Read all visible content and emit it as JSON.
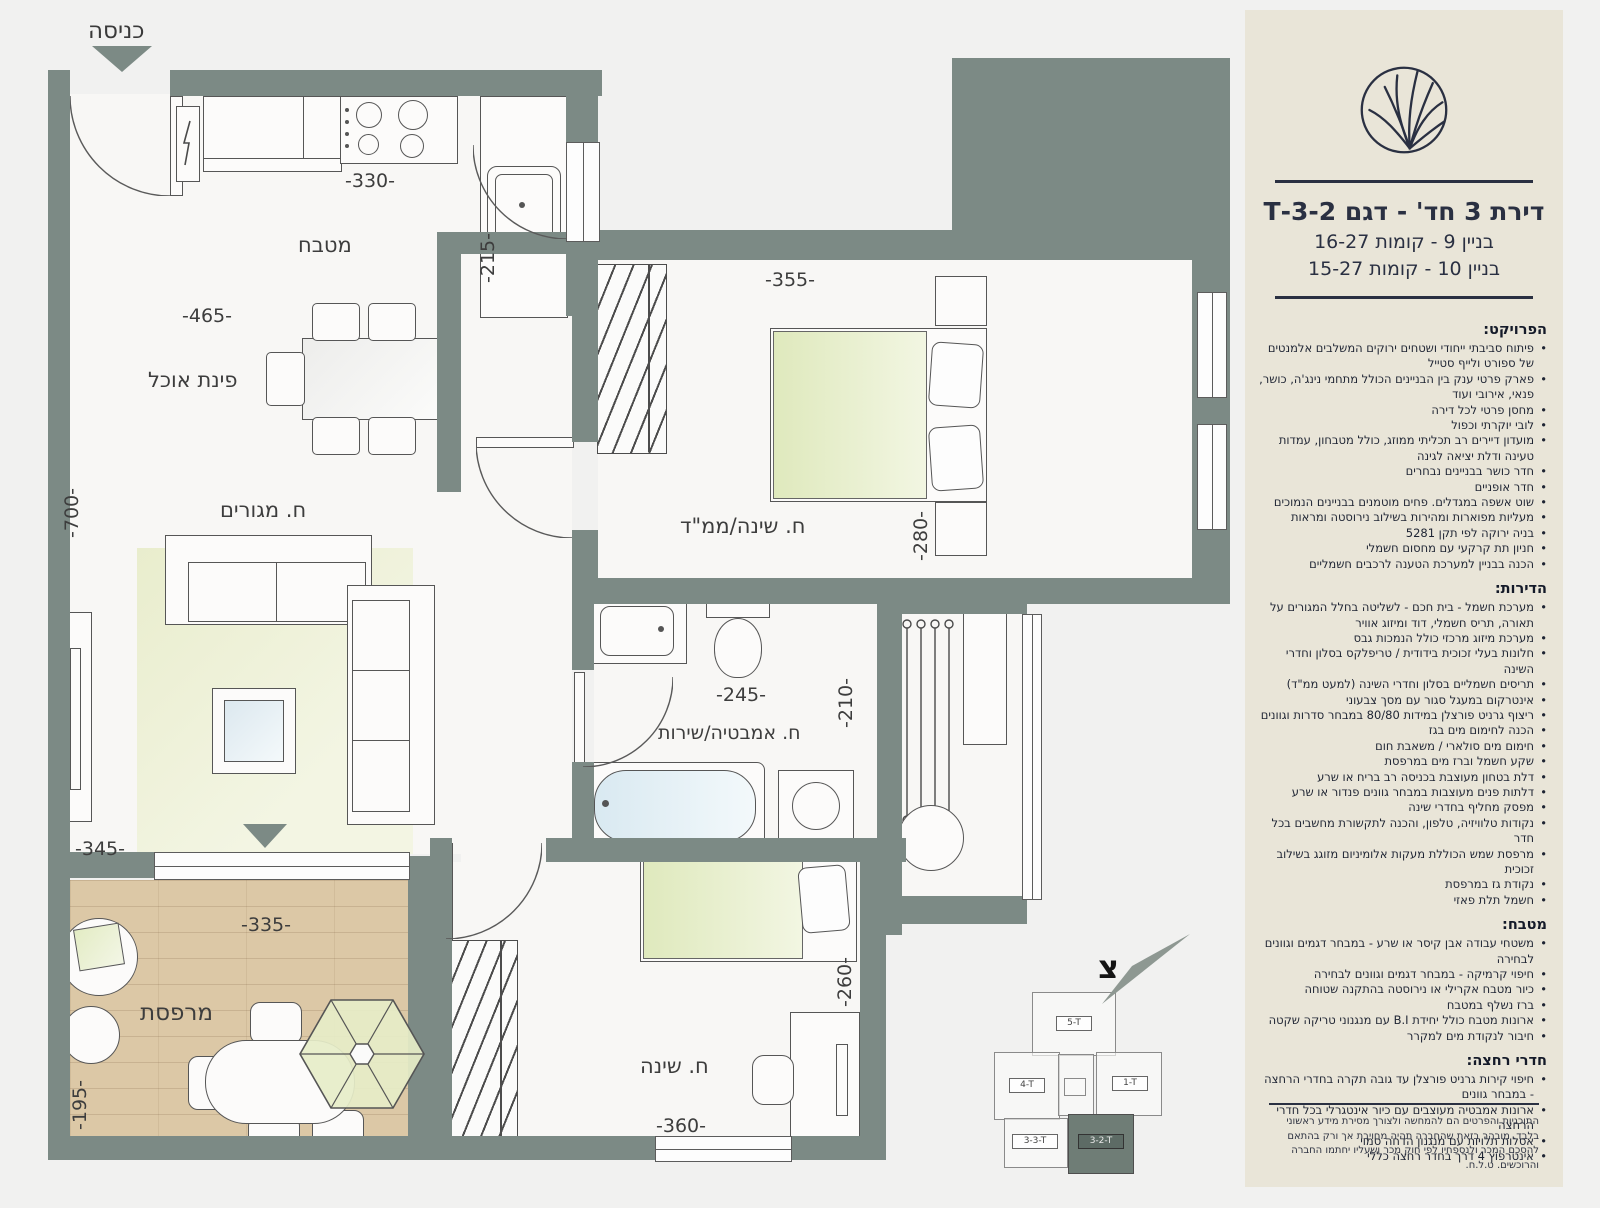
{
  "panel": {
    "title": "דירת 3 חד' - דגם 3-2-T",
    "building_lines": [
      "בניין 9  - קומות 16-27",
      "בניין 10 - קומות 15-27"
    ],
    "sections": [
      {
        "heading": "הפרויקט:",
        "items": [
          "פיתוח סביבתי ייחודי ושטחים ירוקים המשלבים אלמנטים של ספורט ולייף סטייל",
          "פארק פרטי ענק בין הבניינים הכולל מתחמי נינג'ה, כושר, פנאי, אירובי ועוד",
          "מחסן פרטי לכל דירה",
          "לובי יוקרתי וכפול",
          "מועדון דיירים רב תכליתי ממוזג, כולל מטבחון, עמדות טעינה ודלת יציאה לגינה",
          "חדר כושר בבניינים נבחרים",
          "חדר אופניים",
          "שוט אשפה במגדלים. פחים מוטמנים בבניינים הנמוכים",
          "מעליות מפוארות ומהירות בשילוב נירוסטה ומראות",
          "בניה ירוקה לפי תקן 5281",
          "חניון תת קרקעי עם מחסום חשמלי",
          "הכנה בבניין למערכת הטענה לרכבים חשמליים"
        ]
      },
      {
        "heading": "הדירות:",
        "items": [
          "מערכת חשמל - בית חכם - לשליטה בחלל המגורים על תאורה, תריס חשמלי, דוד ומיזוג אוויר",
          "מערכת מיזוג מרכזי כולל הנמכות גבס",
          "חלונות בעלי זכוכית בידודית / טריפלקס בסלון וחדרי השינה",
          "תריסים חשמליים בסלון וחדרי השינה (למעט ממ\"ד)",
          "אינטרקום במעגל סגור עם מסך צבעוני",
          "ריצוף גרניט פורצלן במידות 80/80 במבחר סדרות וגוונים",
          "הכנה לחימום מים בגז",
          "חימום מים סולארי / משאבת חום",
          "שקע חשמל וברז מים במרפסת",
          "דלת בטחון מעוצבת בכניסה רב בריח או שרע",
          "דלתות פנים מעוצבות במבחר גוונים פנדור או שרע",
          "מפסק מחליף בחדרי שינה",
          "נקודות טלוויזיה, טלפון, והכנה לתקשורת מחשבים בכל חדר",
          "מרפסת שמש הכוללת מעקות אלומיניום מזוגג בשילוב זכוכית",
          "נקודת גז במרפסת",
          "חשמל תלת פאזי"
        ]
      },
      {
        "heading": "מטבח:",
        "items": [
          "משטחי עבודה אבן קיסר או שרע - במבחר דגמים וגוונים לבחירה",
          "חיפוי קרמיקה - במבחר דגמים וגוונים לבחירה",
          "כיור מטבח אקרילי או נירוסטה בהתקנה שטוחה",
          "ברז נשלף במטבח",
          "ארונות מטבח כולל יחידת B.I עם מנגנוני טריקה שקטה",
          "חיבור לנקודת מים למקרר"
        ]
      },
      {
        "heading": "חדרי רחצה:",
        "items": [
          "חיפוי קירות גרניט פורצלן עד גובה תקרה בחדרי הרחצה - במבחר גוונים",
          "ארונות אמבטיה מעוצבים עם כיור אינטגרלי בכל חדרי הרחצה",
          "אסלות תלויות עם מנגנון הדחה סמוי",
          "אינטרפוץ 4 דרך בחדר רחצה כללי"
        ]
      }
    ],
    "disclaimer": "התוכניות והפרטים הם להמחשה ולצורך מסירת מידע ראשוני בלבד. מובהר בזאת שהחברה תהיה מחויבת אך ורק בהתאם להסכם המכר ולנספחיו לפי חוק מכר ושעליו יחתמו החברה והרוכשים. ט.ל.ח."
  },
  "plan": {
    "entry_label": "כניסה",
    "north_letter": "צ",
    "rooms": {
      "kitchen": "מטבח",
      "dining": "פינת אוכל",
      "living": "ח. מגורים",
      "master": "ח. שינה/ממ\"ד",
      "bath": "ח. אמבטיה/שירות",
      "bed2": "ח. שינה",
      "balcony": "מרפסת"
    },
    "dims": {
      "d330": "-330-",
      "d215": "-215-",
      "d465": "-465-",
      "d700": "-700-",
      "d345": "-345-",
      "d355": "-355-",
      "d280": "-280-",
      "d245": "-245-",
      "d210": "-210-",
      "d360": "-360-",
      "d260": "-260-",
      "d335": "-335-",
      "d195": "-195-"
    }
  },
  "keyplan": {
    "units": [
      "5-T",
      "4-T",
      "1-T",
      "3-3-T",
      "3-2-T"
    ],
    "highlighted": "3-2-T"
  },
  "colors": {
    "wall": "#7c8a85",
    "panel_bg": "#e9e5d8",
    "accent_navy": "#2a3042",
    "deck": "#dcc8a6"
  }
}
